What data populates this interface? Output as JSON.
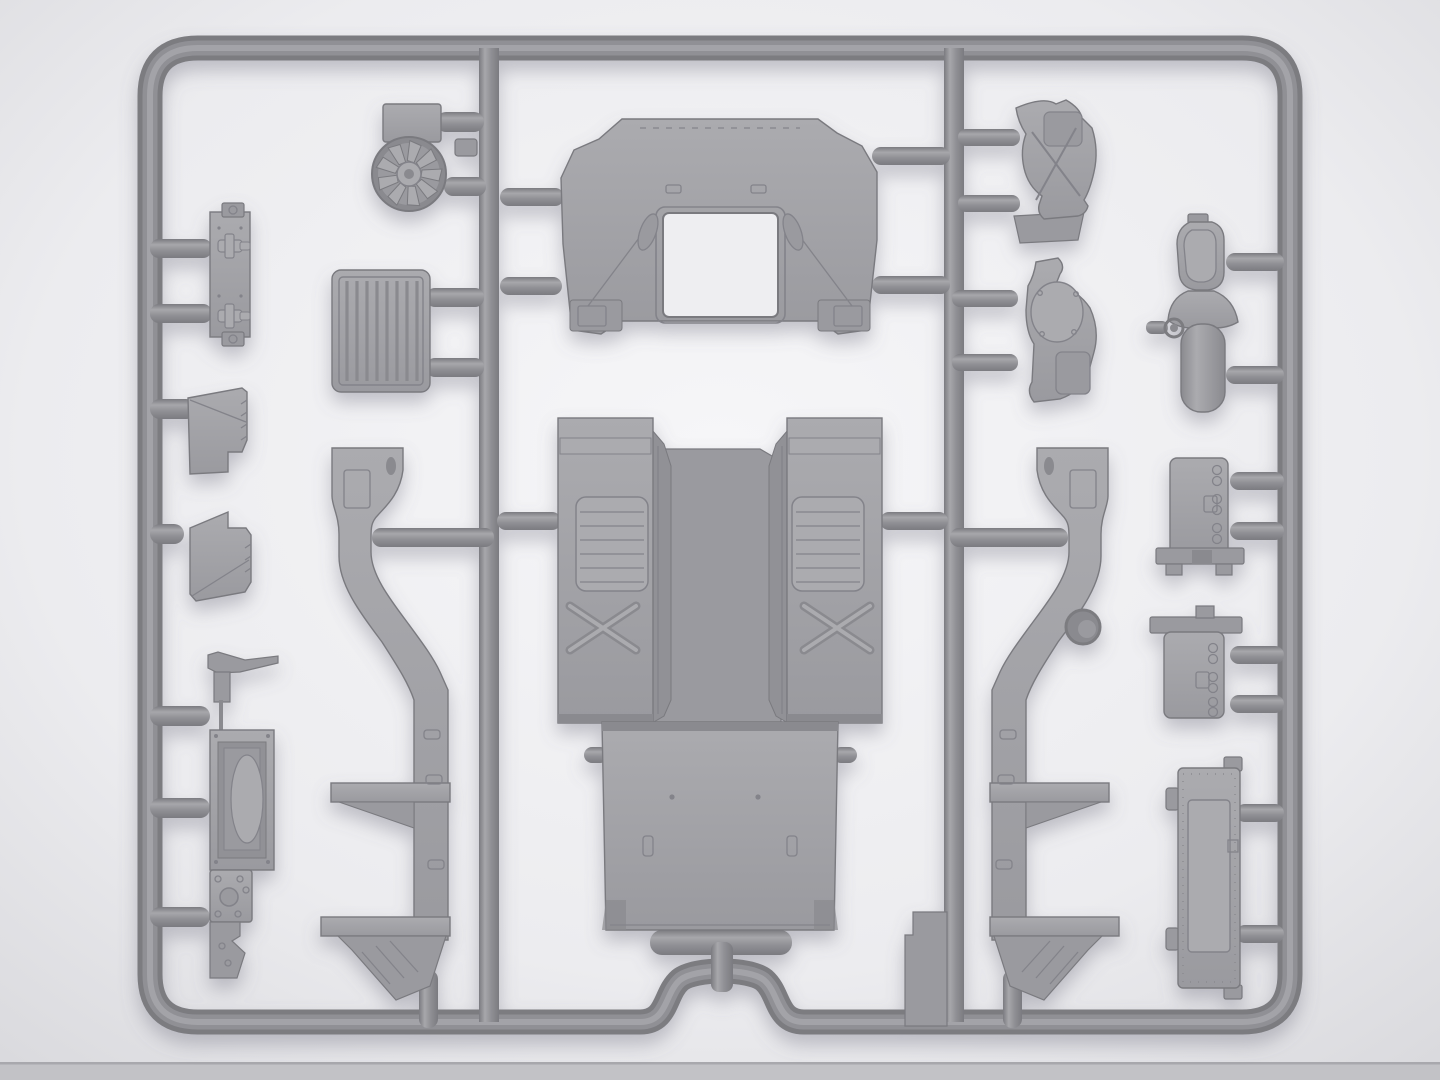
{
  "scene": {
    "type": "model-kit-sprue-photo",
    "subject": "gray injection-molded sprue with unassembled vehicle model parts",
    "plastic_color_name": "gray",
    "text_visible": "none"
  },
  "colors": {
    "bg-center": "#f6f6f8",
    "bg-mid": "#ececef",
    "bg-edge": "#d8d8dc",
    "bg-strip": "#c2c2c6",
    "bg-strip-edge": "#a8a8ad",
    "tube-dark": "#7b7b80",
    "tube-mid": "#909095",
    "tube-light": "#a7a7ab",
    "part-light": "#ababaf",
    "part-mid": "#9a9a9f",
    "part-dark": "#8a8a8f",
    "edge": "#7a7a7f",
    "detail": "#83838a",
    "recess": "#919196",
    "window": "#eeeef1",
    "shadow": "#6e6e7e"
  },
  "parts": [
    {
      "name": "sprue-frame",
      "kind": "runner-frame"
    },
    {
      "name": "cooling-fan",
      "kind": "part"
    },
    {
      "name": "fan-mount-bracket",
      "kind": "part"
    },
    {
      "name": "side-clamp-bracket",
      "kind": "part"
    },
    {
      "name": "radiator-grille",
      "kind": "part"
    },
    {
      "name": "hood-panel",
      "kind": "part"
    },
    {
      "name": "louvered-side-panel-upper",
      "kind": "part"
    },
    {
      "name": "louvered-side-panel-lower",
      "kind": "part"
    },
    {
      "name": "radiator-dashboard-assembly",
      "kind": "part"
    },
    {
      "name": "chassis-rail-left",
      "kind": "part"
    },
    {
      "name": "chassis-rail-right",
      "kind": "part"
    },
    {
      "name": "fender-step-left",
      "kind": "part"
    },
    {
      "name": "fender-step-right",
      "kind": "part"
    },
    {
      "name": "cab-floor-center",
      "kind": "part"
    },
    {
      "name": "cargo-floor-panel",
      "kind": "part"
    },
    {
      "name": "cowl-bracket-upper",
      "kind": "part"
    },
    {
      "name": "cowl-bracket-lower",
      "kind": "part"
    },
    {
      "name": "air-filter-assembly",
      "kind": "part"
    },
    {
      "name": "engine-block-upper",
      "kind": "part"
    },
    {
      "name": "engine-block-lower",
      "kind": "part"
    },
    {
      "name": "radiator-core-panel",
      "kind": "part"
    },
    {
      "name": "sprue-tab",
      "kind": "runner-tab"
    }
  ]
}
